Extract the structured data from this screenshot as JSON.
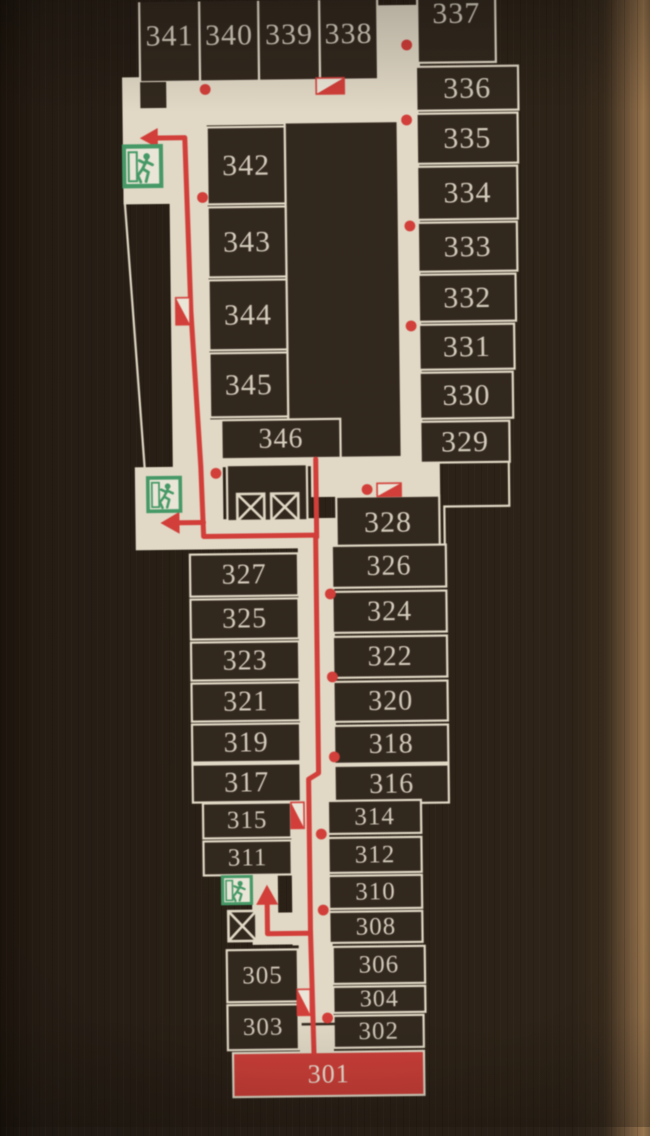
{
  "scene": {
    "type": "hotel-floor-evacuation-map",
    "highlighted_room": "301"
  },
  "palette": {
    "background_dark": "#261e16",
    "floor": "#e8e1cf",
    "room_fill": "#2d241c",
    "line_cream": "#e8e1cf",
    "number_color": "#d9d3c4",
    "route_red": "#dd3a37",
    "highlight_room_fill": "#d63a36",
    "highlight_room_text": "#f4eee1",
    "exit_green": "#3e9e68",
    "exit_inner": "#f2efe3"
  },
  "map": {
    "floors": [
      [
        128,
        75,
        84,
        127
      ],
      [
        140,
        80,
        284,
        44
      ],
      [
        378,
        6,
        48,
        78
      ],
      [
        400,
        62,
        24,
        406
      ],
      [
        174,
        202,
        38,
        266
      ],
      [
        136,
        465,
        76,
        83
      ],
      [
        210,
        418,
        14,
        130
      ],
      [
        136,
        518,
        200,
        30
      ],
      [
        312,
        458,
        129,
        39
      ],
      [
        222,
        458,
        120,
        8
      ],
      [
        298,
        545,
        36,
        260
      ],
      [
        288,
        800,
        38,
        145
      ],
      [
        248,
        872,
        26,
        72
      ],
      [
        248,
        912,
        60,
        32
      ],
      [
        294,
        940,
        34,
        114
      ]
    ],
    "core_blocks": [
      {
        "x": 290,
        "y": 122,
        "w": 113,
        "h": 336,
        "stroke": 1,
        "z": 0
      },
      {
        "x": 228,
        "y": 464,
        "w": 80,
        "h": 56,
        "stroke": 1,
        "z": 0
      },
      {
        "x": 146,
        "y": 80,
        "w": 26,
        "h": 26,
        "stroke": 0,
        "z": 1
      }
    ],
    "boundary_lines": [
      [
        [
          129,
          196
        ],
        [
          146,
          468
        ]
      ],
      [
        [
          510,
          464
        ],
        [
          510,
          508
        ],
        [
          445,
          508
        ],
        [
          445,
          548
        ]
      ]
    ],
    "rooms": [
      {
        "n": "341",
        "x": 146,
        "y": -12,
        "w": 60,
        "h": 92,
        "fs": 30
      },
      {
        "n": "340",
        "x": 206,
        "y": -12,
        "w": 59,
        "h": 92,
        "fs": 30
      },
      {
        "n": "339",
        "x": 265,
        "y": -12,
        "w": 61,
        "h": 92,
        "fs": 30
      },
      {
        "n": "338",
        "x": 326,
        "y": -12,
        "w": 58,
        "h": 92,
        "fs": 30
      },
      {
        "n": "337",
        "x": 424,
        "y": -16,
        "w": 78,
        "h": 80,
        "fs": 30,
        "ty": -9
      },
      {
        "n": "336",
        "x": 422,
        "y": 68,
        "w": 102,
        "h": 44,
        "fs": 30
      },
      {
        "n": "335",
        "x": 422,
        "y": 115,
        "w": 101,
        "h": 50,
        "fs": 30
      },
      {
        "n": "334",
        "x": 422,
        "y": 168,
        "w": 100,
        "h": 53,
        "fs": 30
      },
      {
        "n": "333",
        "x": 422,
        "y": 224,
        "w": 99,
        "h": 49,
        "fs": 30
      },
      {
        "n": "332",
        "x": 422,
        "y": 276,
        "w": 97,
        "h": 47,
        "fs": 30
      },
      {
        "n": "331",
        "x": 422,
        "y": 326,
        "w": 95,
        "h": 45,
        "fs": 30
      },
      {
        "n": "330",
        "x": 422,
        "y": 374,
        "w": 93,
        "h": 46,
        "fs": 30
      },
      {
        "n": "329",
        "x": 422,
        "y": 423,
        "w": 89,
        "h": 41,
        "fs": 30
      },
      {
        "n": "342",
        "x": 212,
        "y": 126,
        "w": 78,
        "h": 77,
        "fs": 30
      },
      {
        "n": "343",
        "x": 212,
        "y": 206,
        "w": 78,
        "h": 70,
        "fs": 30
      },
      {
        "n": "344",
        "x": 212,
        "y": 279,
        "w": 78,
        "h": 70,
        "fs": 30
      },
      {
        "n": "345",
        "x": 212,
        "y": 352,
        "w": 78,
        "h": 64,
        "fs": 30
      },
      {
        "n": "346",
        "x": 223,
        "y": 419,
        "w": 119,
        "h": 39,
        "fs": 28
      },
      {
        "n": "328",
        "x": 337,
        "y": 497,
        "w": 103,
        "h": 52,
        "fs": 30
      },
      {
        "n": "327",
        "x": 190,
        "y": 553,
        "w": 108,
        "h": 42,
        "fs": 28
      },
      {
        "n": "325",
        "x": 190,
        "y": 598,
        "w": 108,
        "h": 40,
        "fs": 28
      },
      {
        "n": "323",
        "x": 190,
        "y": 641,
        "w": 108,
        "h": 38,
        "fs": 28
      },
      {
        "n": "321",
        "x": 190,
        "y": 682,
        "w": 108,
        "h": 38,
        "fs": 28
      },
      {
        "n": "319",
        "x": 190,
        "y": 723,
        "w": 108,
        "h": 38,
        "fs": 28
      },
      {
        "n": "317",
        "x": 190,
        "y": 763,
        "w": 108,
        "h": 38,
        "fs": 28
      },
      {
        "n": "326",
        "x": 332,
        "y": 546,
        "w": 114,
        "h": 42,
        "fs": 28
      },
      {
        "n": "324",
        "x": 332,
        "y": 592,
        "w": 114,
        "h": 41,
        "fs": 28
      },
      {
        "n": "322",
        "x": 332,
        "y": 637,
        "w": 114,
        "h": 41,
        "fs": 28
      },
      {
        "n": "320",
        "x": 332,
        "y": 682,
        "w": 114,
        "h": 40,
        "fs": 28
      },
      {
        "n": "318",
        "x": 332,
        "y": 726,
        "w": 114,
        "h": 38,
        "fs": 28
      },
      {
        "n": "316",
        "x": 332,
        "y": 766,
        "w": 114,
        "h": 38,
        "fs": 28
      },
      {
        "n": "315",
        "x": 200,
        "y": 802,
        "w": 88,
        "h": 35,
        "fs": 25
      },
      {
        "n": "311",
        "x": 200,
        "y": 840,
        "w": 88,
        "h": 34,
        "fs": 25
      },
      {
        "n": "314",
        "x": 325,
        "y": 801,
        "w": 93,
        "h": 33,
        "fs": 25
      },
      {
        "n": "312",
        "x": 325,
        "y": 838,
        "w": 93,
        "h": 35,
        "fs": 25
      },
      {
        "n": "310",
        "x": 325,
        "y": 876,
        "w": 93,
        "h": 33,
        "fs": 25
      },
      {
        "n": "308",
        "x": 325,
        "y": 912,
        "w": 93,
        "h": 31,
        "fs": 25
      },
      {
        "n": "306",
        "x": 328,
        "y": 947,
        "w": 92,
        "h": 37,
        "fs": 25
      },
      {
        "n": "304",
        "x": 328,
        "y": 987,
        "w": 92,
        "h": 26,
        "fs": 24
      },
      {
        "n": "302",
        "x": 328,
        "y": 1016,
        "w": 90,
        "h": 32,
        "fs": 25
      },
      {
        "n": "305",
        "x": 222,
        "y": 949,
        "w": 71,
        "h": 52,
        "fs": 25
      },
      {
        "n": "303",
        "x": 222,
        "y": 1004,
        "w": 71,
        "h": 45,
        "fs": 25
      },
      {
        "n": "301",
        "x": 227,
        "y": 1052,
        "w": 191,
        "h": 44,
        "fs": 26,
        "highlight": 1
      }
    ],
    "route": {
      "width": 5,
      "paths": [
        [
          [
            158,
            136
          ],
          [
            190,
            136
          ],
          [
            194,
            310
          ],
          [
            202,
            465
          ],
          [
            204,
            535
          ],
          [
            316,
            535
          ],
          [
            316,
            773
          ],
          [
            306,
            779
          ],
          [
            306,
            930
          ],
          [
            308,
            1053
          ]
        ],
        [
          [
            317,
            459
          ],
          [
            317,
            537
          ]
        ],
        [
          [
            204,
            521
          ],
          [
            176,
            521
          ]
        ],
        [
          [
            306,
            933
          ],
          [
            263,
            933
          ],
          [
            263,
            899
          ]
        ]
      ],
      "arrowheads": [
        [
          [
            145,
            136
          ],
          [
            163,
            126
          ],
          [
            163,
            146
          ]
        ],
        [
          [
            161,
            521
          ],
          [
            180,
            510
          ],
          [
            180,
            532
          ]
        ],
        [
          [
            263,
            884
          ],
          [
            252,
            904
          ],
          [
            274,
            904
          ]
        ]
      ]
    },
    "dots": [
      [
        211,
        88
      ],
      [
        413,
        46
      ],
      [
        412,
        121
      ],
      [
        414,
        227
      ],
      [
        414,
        327
      ],
      [
        207,
        196
      ],
      [
        217,
        472
      ],
      [
        368,
        490
      ],
      [
        330,
        594
      ],
      [
        331,
        677
      ],
      [
        332,
        757
      ],
      [
        318,
        834
      ],
      [
        319,
        910
      ],
      [
        322,
        1018
      ]
    ],
    "hydrant_markers": [
      {
        "x": 322,
        "y": 78,
        "w": 28,
        "h": 16,
        "o": "h"
      },
      {
        "x": 179,
        "y": 296,
        "w": 14,
        "h": 27,
        "o": "v"
      },
      {
        "x": 378,
        "y": 484,
        "w": 24,
        "h": 13,
        "o": "h"
      },
      {
        "x": 288,
        "y": 802,
        "w": 13,
        "h": 26,
        "o": "v"
      },
      {
        "x": 292,
        "y": 989,
        "w": 13,
        "h": 26,
        "o": "v"
      }
    ],
    "exit_signs": [
      {
        "x": 127,
        "y": 142,
        "w": 41,
        "h": 44
      },
      {
        "x": 147,
        "y": 474,
        "w": 36,
        "h": 37
      },
      {
        "x": 217,
        "y": 874,
        "w": 32,
        "h": 30
      }
    ],
    "elevators": [
      {
        "x": 238,
        "y": 493,
        "w": 27,
        "h": 27
      },
      {
        "x": 272,
        "y": 493,
        "w": 27,
        "h": 27
      },
      {
        "x": 224,
        "y": 910,
        "w": 28,
        "h": 30
      }
    ],
    "door_lines": [
      [
        [
          296,
          1024
        ],
        [
          330,
          1024
        ]
      ]
    ]
  }
}
